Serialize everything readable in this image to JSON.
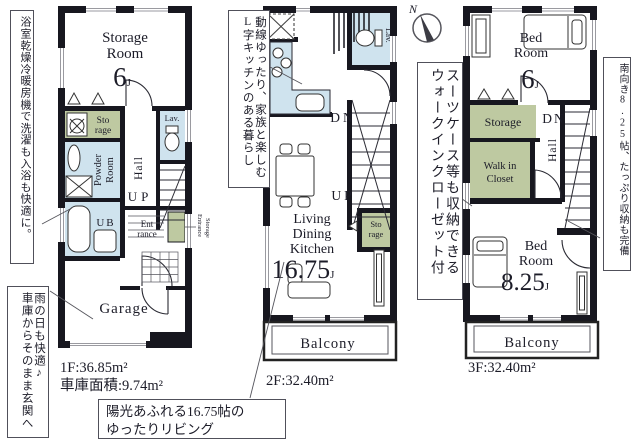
{
  "compass": {
    "north": "N"
  },
  "colors": {
    "wall": "#17171f",
    "water_room_fill": "#cfe3ee",
    "storage_fill": "#bec9a1",
    "text": "#1c1c28",
    "window_line": "#9a9aa0",
    "callout_border": "#50505a"
  },
  "floors": {
    "f1": {
      "area": "1F:36.85m²",
      "garage_area": "車庫面積:9.74m²",
      "labels": {
        "storage_room_1": "Storage",
        "storage_room_2": "Room",
        "storage_room_size": "6",
        "storage_room_unit": "J",
        "sto_1": "Sto",
        "sto_2": "rage",
        "powder_1": "Powder",
        "powder_2": "Room",
        "ub": "UB",
        "hall": "Hall",
        "lav": "Lav.",
        "up": "UP",
        "ent_1": "Ent",
        "ent_2": "rance",
        "ent_storage_1": "Entrance",
        "ent_storage_2": "Storage",
        "garage": "Garage"
      }
    },
    "f2": {
      "area": "2F:32.40m²",
      "labels": {
        "lav": "Lav.",
        "dn": "DN",
        "up": "UP",
        "ldk_1": "Living",
        "ldk_2": "Dining",
        "ldk_3": "Kitchen",
        "ldk_size": "16.75",
        "ldk_unit": "J",
        "sto_1": "Sto",
        "sto_2": "rage",
        "balcony": "Balcony"
      }
    },
    "f3": {
      "area": "3F:32.40m²",
      "labels": {
        "bed6_1": "Bed",
        "bed6_2": "Room",
        "bed6_size": "6",
        "bed6_unit": "J",
        "storage": "Storage",
        "wic_1": "Walk in",
        "wic_2": "Closet",
        "dn": "DN",
        "hall": "Hall",
        "bed825_1": "Bed",
        "bed825_2": "Room",
        "bed825_size": "8.25",
        "bed825_unit": "J",
        "balcony": "Balcony"
      }
    }
  },
  "callouts": {
    "bath": {
      "text": "浴室乾燥冷暖房機で洗濯も入浴も快適に。"
    },
    "garage": {
      "line1": "雨の日も快適♪",
      "line2": "車庫からそのまま玄関へ"
    },
    "kitchen": {
      "line1": "動線ゆったり、家族と楽しむ",
      "line2": "L字キッチンのある暮らし"
    },
    "wic": {
      "line1": "スーツケース等も収納できる",
      "line2": "ウォークインクローゼット付"
    },
    "south": {
      "text": "南向き8.25帖、たっぷり収納も完備"
    },
    "living": {
      "line1": "陽光あふれる16.75帖の",
      "line2": "ゆったりリビング"
    }
  }
}
